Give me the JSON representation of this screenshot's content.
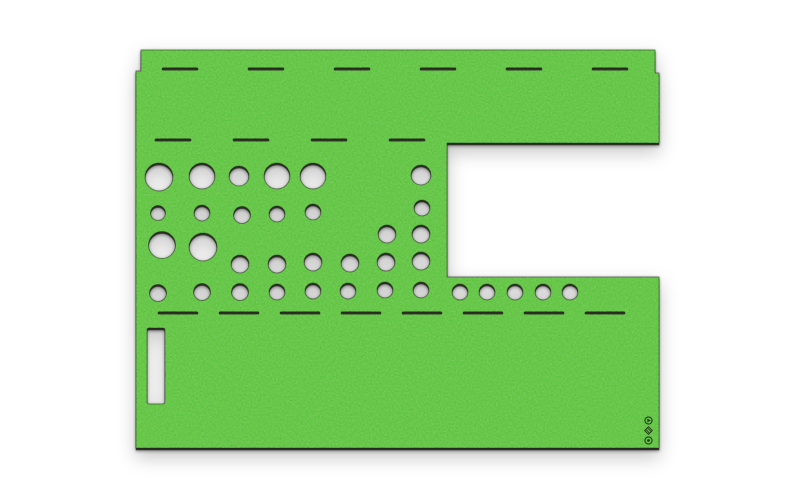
{
  "image": {
    "width": 800,
    "height": 498,
    "background_color": "#ffffff"
  },
  "colors": {
    "felt_green": "#5cc23e",
    "felt_speckle_light": "#6ecc50",
    "cut_edge_dark": "#1c2012",
    "hole_interior": "#ffffff",
    "mark_ink": "#1b2413"
  },
  "felt_sheet": {
    "outline_points": [
      [
        141,
        50
      ],
      [
        655,
        50
      ],
      [
        655,
        73
      ],
      [
        659,
        73
      ],
      [
        659,
        143
      ],
      [
        447,
        143
      ],
      [
        447,
        277
      ],
      [
        659,
        277
      ],
      [
        659,
        448
      ],
      [
        136,
        448
      ],
      [
        136,
        71
      ],
      [
        141,
        71
      ]
    ],
    "notch": {
      "x": 447,
      "y": 143,
      "open_side": "right",
      "bottom": 277
    },
    "holes": [
      {
        "x": 159,
        "y": 177,
        "r": 14
      },
      {
        "x": 202,
        "y": 176,
        "r": 13
      },
      {
        "x": 239,
        "y": 176,
        "r": 10
      },
      {
        "x": 277,
        "y": 176,
        "r": 13
      },
      {
        "x": 313,
        "y": 176,
        "r": 13
      },
      {
        "x": 421,
        "y": 175,
        "r": 10
      },
      {
        "x": 158,
        "y": 213,
        "r": 7.5
      },
      {
        "x": 202,
        "y": 213,
        "r": 8
      },
      {
        "x": 242,
        "y": 215,
        "r": 8.5
      },
      {
        "x": 277,
        "y": 214,
        "r": 8
      },
      {
        "x": 313,
        "y": 212,
        "r": 8
      },
      {
        "x": 422,
        "y": 208,
        "r": 8
      },
      {
        "x": 162,
        "y": 245,
        "r": 13.5
      },
      {
        "x": 203,
        "y": 247,
        "r": 14
      },
      {
        "x": 387,
        "y": 234,
        "r": 9
      },
      {
        "x": 421,
        "y": 234,
        "r": 9
      },
      {
        "x": 240,
        "y": 264,
        "r": 9
      },
      {
        "x": 277,
        "y": 264,
        "r": 9
      },
      {
        "x": 313,
        "y": 262,
        "r": 9
      },
      {
        "x": 350,
        "y": 263,
        "r": 9
      },
      {
        "x": 386,
        "y": 262,
        "r": 9
      },
      {
        "x": 421,
        "y": 261,
        "r": 9
      },
      {
        "x": 158,
        "y": 293,
        "r": 8.5
      },
      {
        "x": 202,
        "y": 292,
        "r": 8.5
      },
      {
        "x": 240,
        "y": 292,
        "r": 8.5
      },
      {
        "x": 277,
        "y": 292,
        "r": 8
      },
      {
        "x": 313,
        "y": 291,
        "r": 8
      },
      {
        "x": 348,
        "y": 291,
        "r": 8
      },
      {
        "x": 385,
        "y": 290,
        "r": 8
      },
      {
        "x": 421,
        "y": 290,
        "r": 8
      },
      {
        "x": 460,
        "y": 292,
        "r": 8
      },
      {
        "x": 487,
        "y": 292,
        "r": 8
      },
      {
        "x": 515,
        "y": 292,
        "r": 8
      },
      {
        "x": 543,
        "y": 292,
        "r": 8
      },
      {
        "x": 570,
        "y": 292,
        "r": 8
      }
    ],
    "slits": [
      {
        "x": 162,
        "y": 69,
        "w": 36
      },
      {
        "x": 248,
        "y": 69,
        "w": 36
      },
      {
        "x": 334,
        "y": 69,
        "w": 36
      },
      {
        "x": 420,
        "y": 69,
        "w": 36
      },
      {
        "x": 506,
        "y": 69,
        "w": 36
      },
      {
        "x": 592,
        "y": 69,
        "w": 36
      },
      {
        "x": 155,
        "y": 140,
        "w": 36
      },
      {
        "x": 233,
        "y": 140,
        "w": 36
      },
      {
        "x": 311,
        "y": 140,
        "w": 36
      },
      {
        "x": 389,
        "y": 140,
        "w": 36
      },
      {
        "x": 158,
        "y": 313,
        "w": 40
      },
      {
        "x": 219,
        "y": 313,
        "w": 40
      },
      {
        "x": 280,
        "y": 313,
        "w": 40
      },
      {
        "x": 341,
        "y": 313,
        "w": 40
      },
      {
        "x": 402,
        "y": 313,
        "w": 40
      },
      {
        "x": 463,
        "y": 313,
        "w": 40
      },
      {
        "x": 524,
        "y": 313,
        "w": 40
      },
      {
        "x": 585,
        "y": 313,
        "w": 40
      }
    ],
    "slot": {
      "x": 147,
      "y": 328,
      "w": 18,
      "h": 76
    },
    "maker_mark": {
      "x": 648.5,
      "icons": [
        {
          "name": "play-circle-icon",
          "y": 420.5
        },
        {
          "name": "hatch-diamond-icon",
          "y": 430.5
        },
        {
          "name": "ring-dot-icon",
          "y": 440.5
        }
      ]
    }
  }
}
